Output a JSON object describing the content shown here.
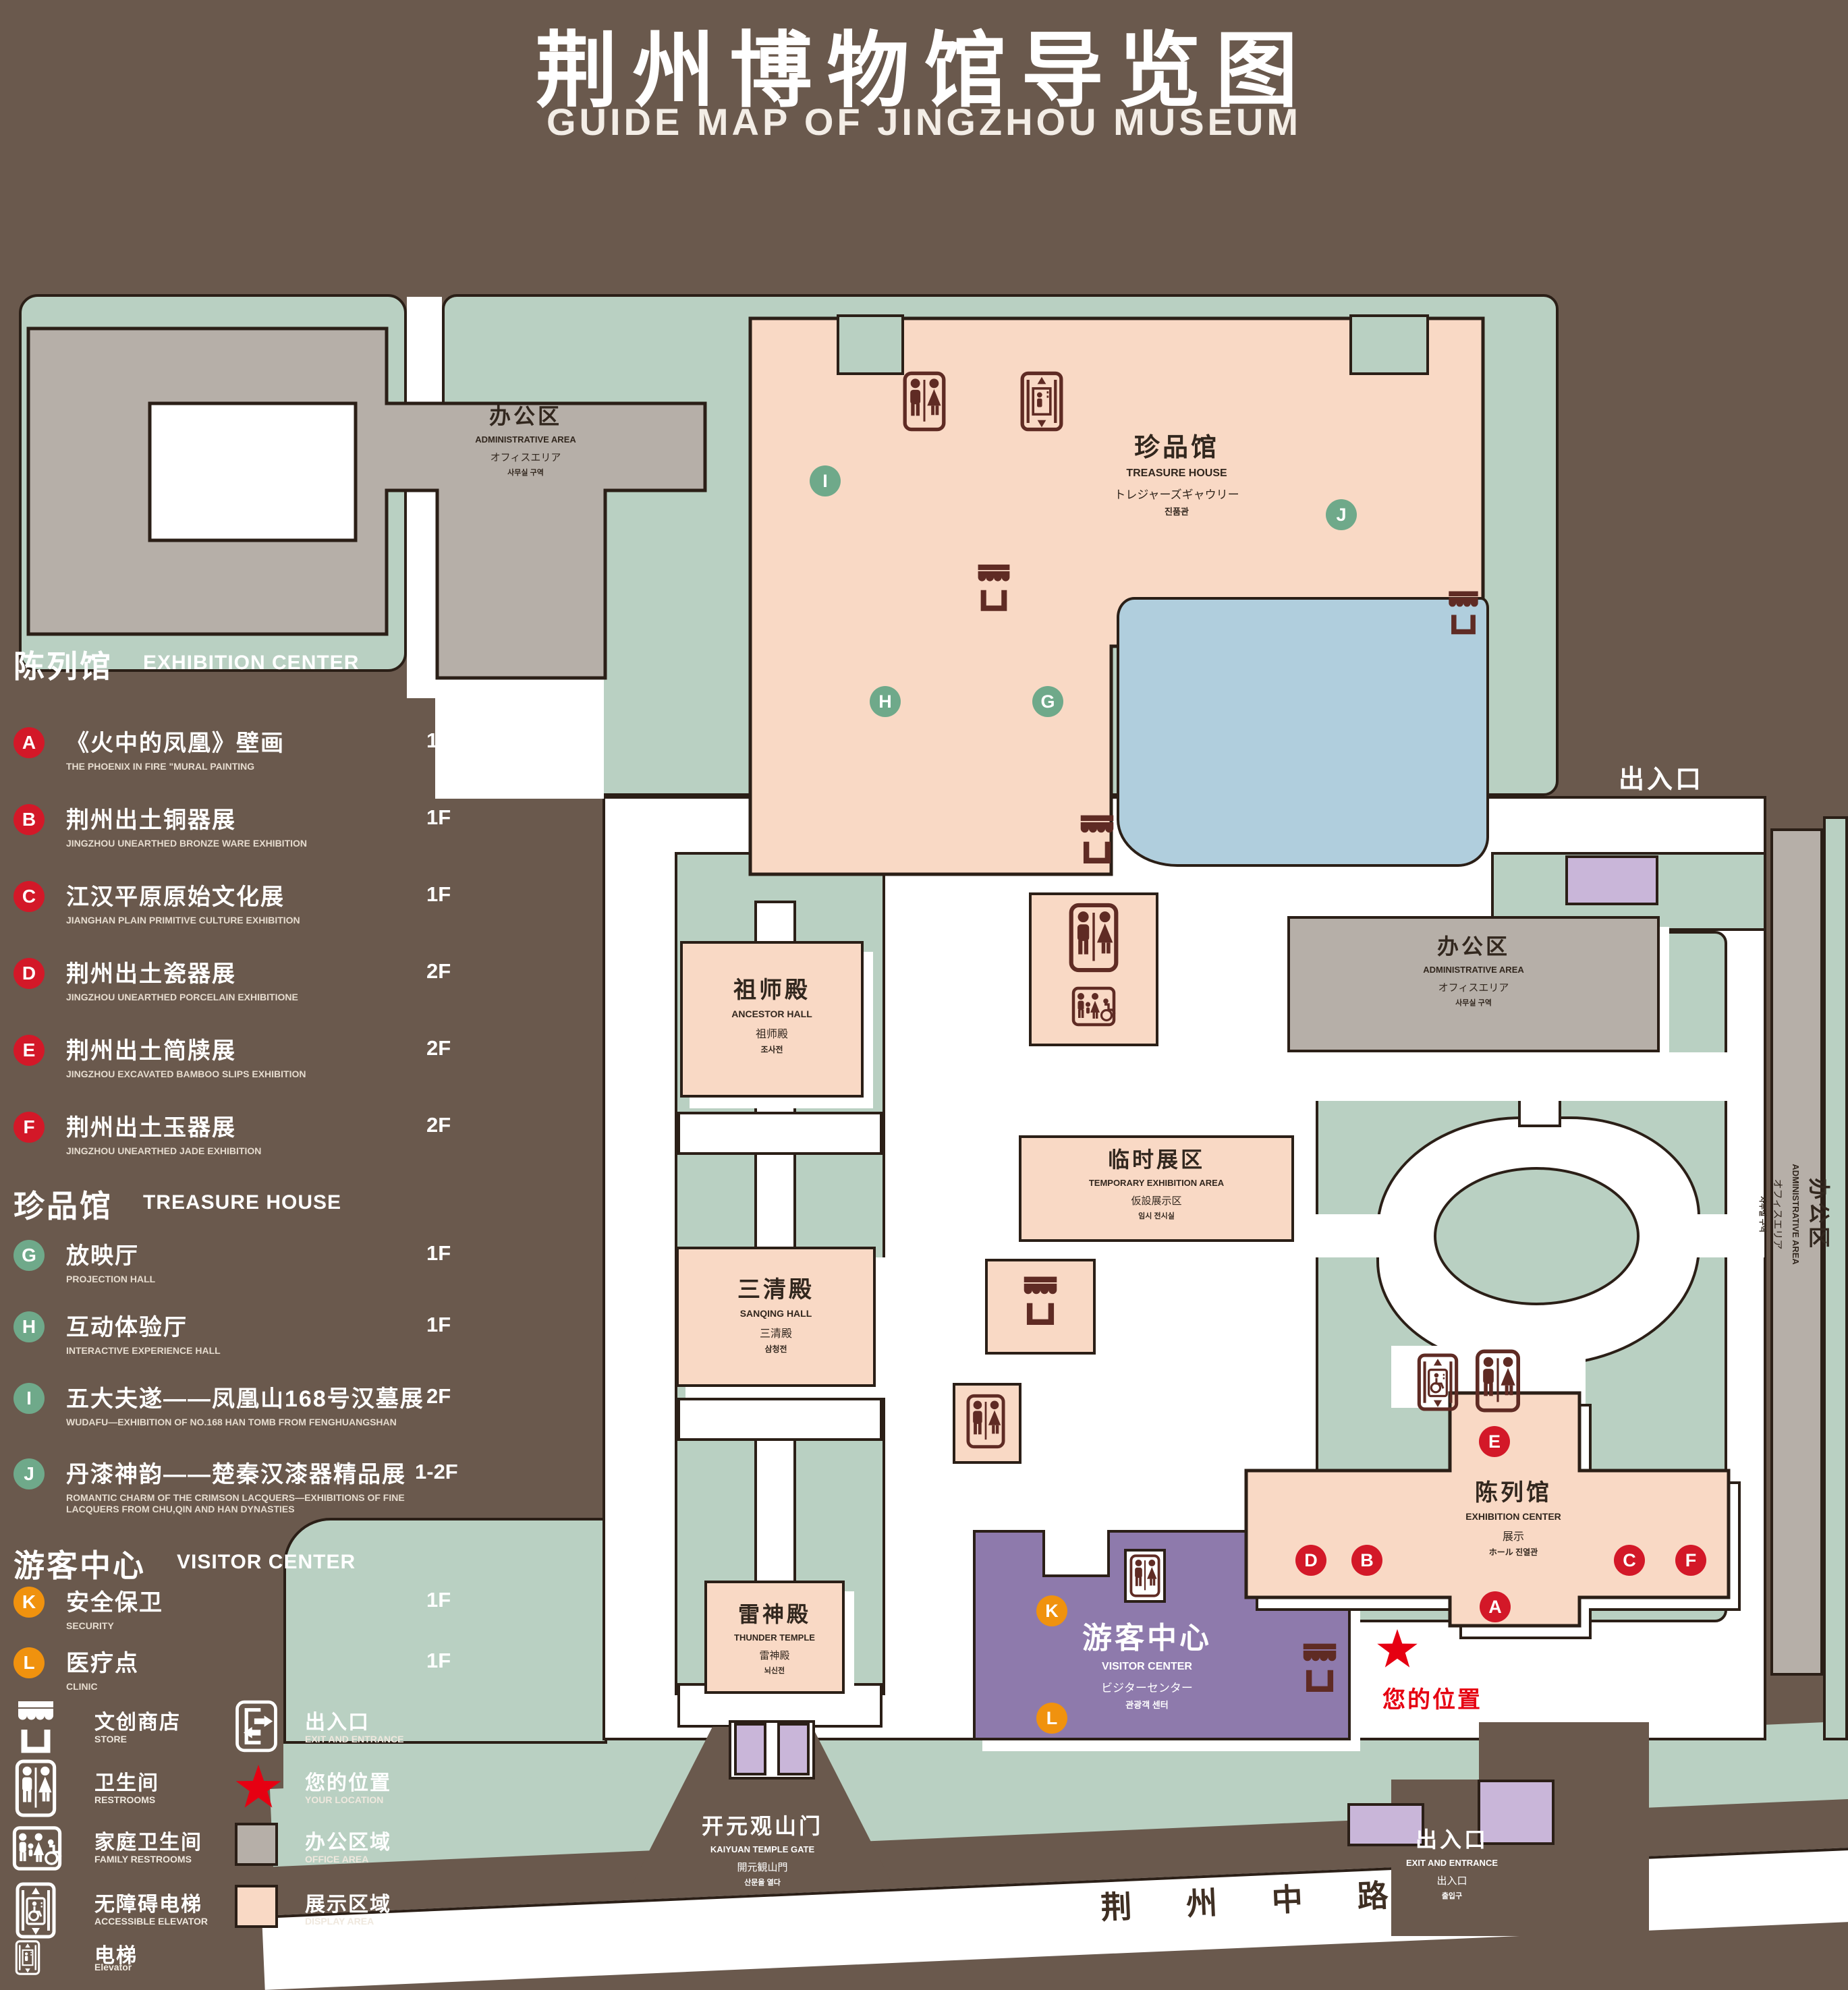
{
  "title": {
    "zh": "荆州博物馆导览图",
    "en": "GUIDE MAP OF JINGZHOU MUSEUM"
  },
  "legend_sections": [
    {
      "zh": "陈列馆",
      "en": "EXHIBITION CENTER",
      "items": [
        {
          "key": "A",
          "zh": "《火中的凤凰》壁画",
          "en": "THE PHOENIX IN FIRE \"MURAL PAINTING",
          "floor": "1F"
        },
        {
          "key": "B",
          "zh": "荆州出土铜器展",
          "en": "JINGZHOU UNEARTHED BRONZE WARE EXHIBITION",
          "floor": "1F"
        },
        {
          "key": "C",
          "zh": "江汉平原原始文化展",
          "en": "JIANGHAN PLAIN PRIMITIVE CULTURE EXHIBITION",
          "floor": "1F"
        },
        {
          "key": "D",
          "zh": "荆州出土瓷器展",
          "en": "JINGZHOU UNEARTHED PORCELAIN EXHIBITIONE",
          "floor": "2F"
        },
        {
          "key": "E",
          "zh": "荆州出土简牍展",
          "en": "JINGZHOU EXCAVATED BAMBOO SLIPS EXHIBITION",
          "floor": "2F"
        },
        {
          "key": "F",
          "zh": "荆州出土玉器展",
          "en": "JINGZHOU UNEARTHED JADE EXHIBITION",
          "floor": "2F"
        }
      ]
    },
    {
      "zh": "珍品馆",
      "en": "TREASURE HOUSE",
      "items": [
        {
          "key": "G",
          "zh": "放映厅",
          "en": "PROJECTION HALL",
          "floor": "1F"
        },
        {
          "key": "H",
          "zh": "互动体验厅",
          "en": "INTERACTIVE EXPERIENCE HALL",
          "floor": "1F"
        },
        {
          "key": "I",
          "zh": "五大夫遂——凤凰山168号汉墓展",
          "en": "WUDAFU—EXHIBITION OF NO.168 HAN TOMB FROM FENGHUANGSHAN",
          "floor": "2F"
        },
        {
          "key": "J",
          "zh": "丹漆神韵——楚秦汉漆器精品展",
          "en": "ROMANTIC CHARM OF THE CRIMSON LACQUERS—EXHIBITIONS OF FINE LACQUERS FROM CHU,QIN AND HAN DYNASTIES",
          "floor": "1-2F"
        }
      ]
    },
    {
      "zh": "游客中心",
      "en": "VISITOR CENTER",
      "items": [
        {
          "key": "K",
          "zh": "安全保卫",
          "en": "SECURITY",
          "floor": "1F"
        },
        {
          "key": "L",
          "zh": "医疗点",
          "en": "CLINIC",
          "floor": "1F"
        }
      ]
    }
  ],
  "legend_icons": [
    {
      "icon": "store-icon",
      "zh": "文创商店",
      "en": "STORE"
    },
    {
      "icon": "exit-icon",
      "zh": "出入口",
      "en": "EXIT AND ENTRANCE"
    },
    {
      "icon": "restrooms-icon",
      "zh": "卫生间",
      "en": "RESTROOMS"
    },
    {
      "icon": "your-location-star",
      "zh": "您的位置",
      "en": "YOUR LOCATION"
    },
    {
      "icon": "family-restrooms-icon",
      "zh": "家庭卫生间",
      "en": "FAMILY RESTROOMS"
    },
    {
      "icon": "office-area-swatch",
      "zh": "办公区域",
      "en": "OFFICE AREA"
    },
    {
      "icon": "accessible-elevator-icon",
      "zh": "无障碍电梯",
      "en": "ACCESSIBLE ELEVATOR"
    },
    {
      "icon": "display-area-swatch",
      "zh": "展示区域",
      "en": "DISPLAY AREA"
    },
    {
      "icon": "elevator-icon",
      "zh": "电梯",
      "en": "Elevator"
    }
  ],
  "map": {
    "buildings": {
      "admin": {
        "zh": "办公区",
        "en": "ADMINISTRATIVE AREA",
        "ja": "オフィスエリア",
        "ko": "사무실 구역"
      },
      "treasure_house": {
        "zh": "珍品馆",
        "en": "TREASURE HOUSE",
        "ja": "トレジャーズギャウリー",
        "ko": "진품관"
      },
      "ancestor_hall": {
        "zh": "祖师殿",
        "en": "ANCESTOR HALL",
        "ja": "祖师殿",
        "ko": "조사전"
      },
      "temporary_area": {
        "zh": "临时展区",
        "en": "TEMPORARY EXHIBITION AREA",
        "ja": "仮設展示区",
        "ko": "임시 전시실"
      },
      "sanqing_hall": {
        "zh": "三清殿",
        "en": "SANQING HALL",
        "ja": "三清殿",
        "ko": "삼청전"
      },
      "thunder_temple": {
        "zh": "雷神殿",
        "en": "THUNDER TEMPLE",
        "ja": "雷神殿",
        "ko": "뇌신전"
      },
      "visitor_center": {
        "zh": "游客中心",
        "en": "VISITOR CENTER",
        "ja": "ビジターセンター",
        "ko": "관광객 센터"
      },
      "exhibition_center": {
        "zh": "陈列馆",
        "en": "EXHIBITION CENTER",
        "ja": "展示",
        "ko": "ホール 진열관"
      },
      "kaiyuan_gate": {
        "zh": "开元观山门",
        "en": "KAIYUAN TEMPLE GATE",
        "ja": "開元観山門",
        "ko": "산문을 열다"
      },
      "exit": {
        "zh": "出入口",
        "en": "EXIT AND ENTRANCE",
        "ja": "出入口",
        "ko": "출입구"
      }
    },
    "markers": [
      {
        "key": "I"
      },
      {
        "key": "J"
      },
      {
        "key": "H"
      },
      {
        "key": "G"
      },
      {
        "key": "E"
      },
      {
        "key": "D"
      },
      {
        "key": "B"
      },
      {
        "key": "C"
      },
      {
        "key": "F"
      },
      {
        "key": "A"
      },
      {
        "key": "K"
      },
      {
        "key": "L"
      }
    ],
    "your_location": "您的位置",
    "road": "荆 州 中 路"
  },
  "colors": {
    "background_brown": "#6a594d",
    "lawn_green": "#b9d0c2",
    "path_white": "#ffffff",
    "display_pink": "#f9d9c5",
    "office_gray": "#b6afa8",
    "lake_blue": "#b0cedd",
    "visitor_purple": "#8e7aac",
    "gate_purple": "#c9b6d9",
    "badge_red": "#d31828",
    "badge_green": "#6fa98a",
    "badge_orange": "#f0920e",
    "icon_dark_red": "#5f2b24",
    "location_red": "#e60012"
  }
}
